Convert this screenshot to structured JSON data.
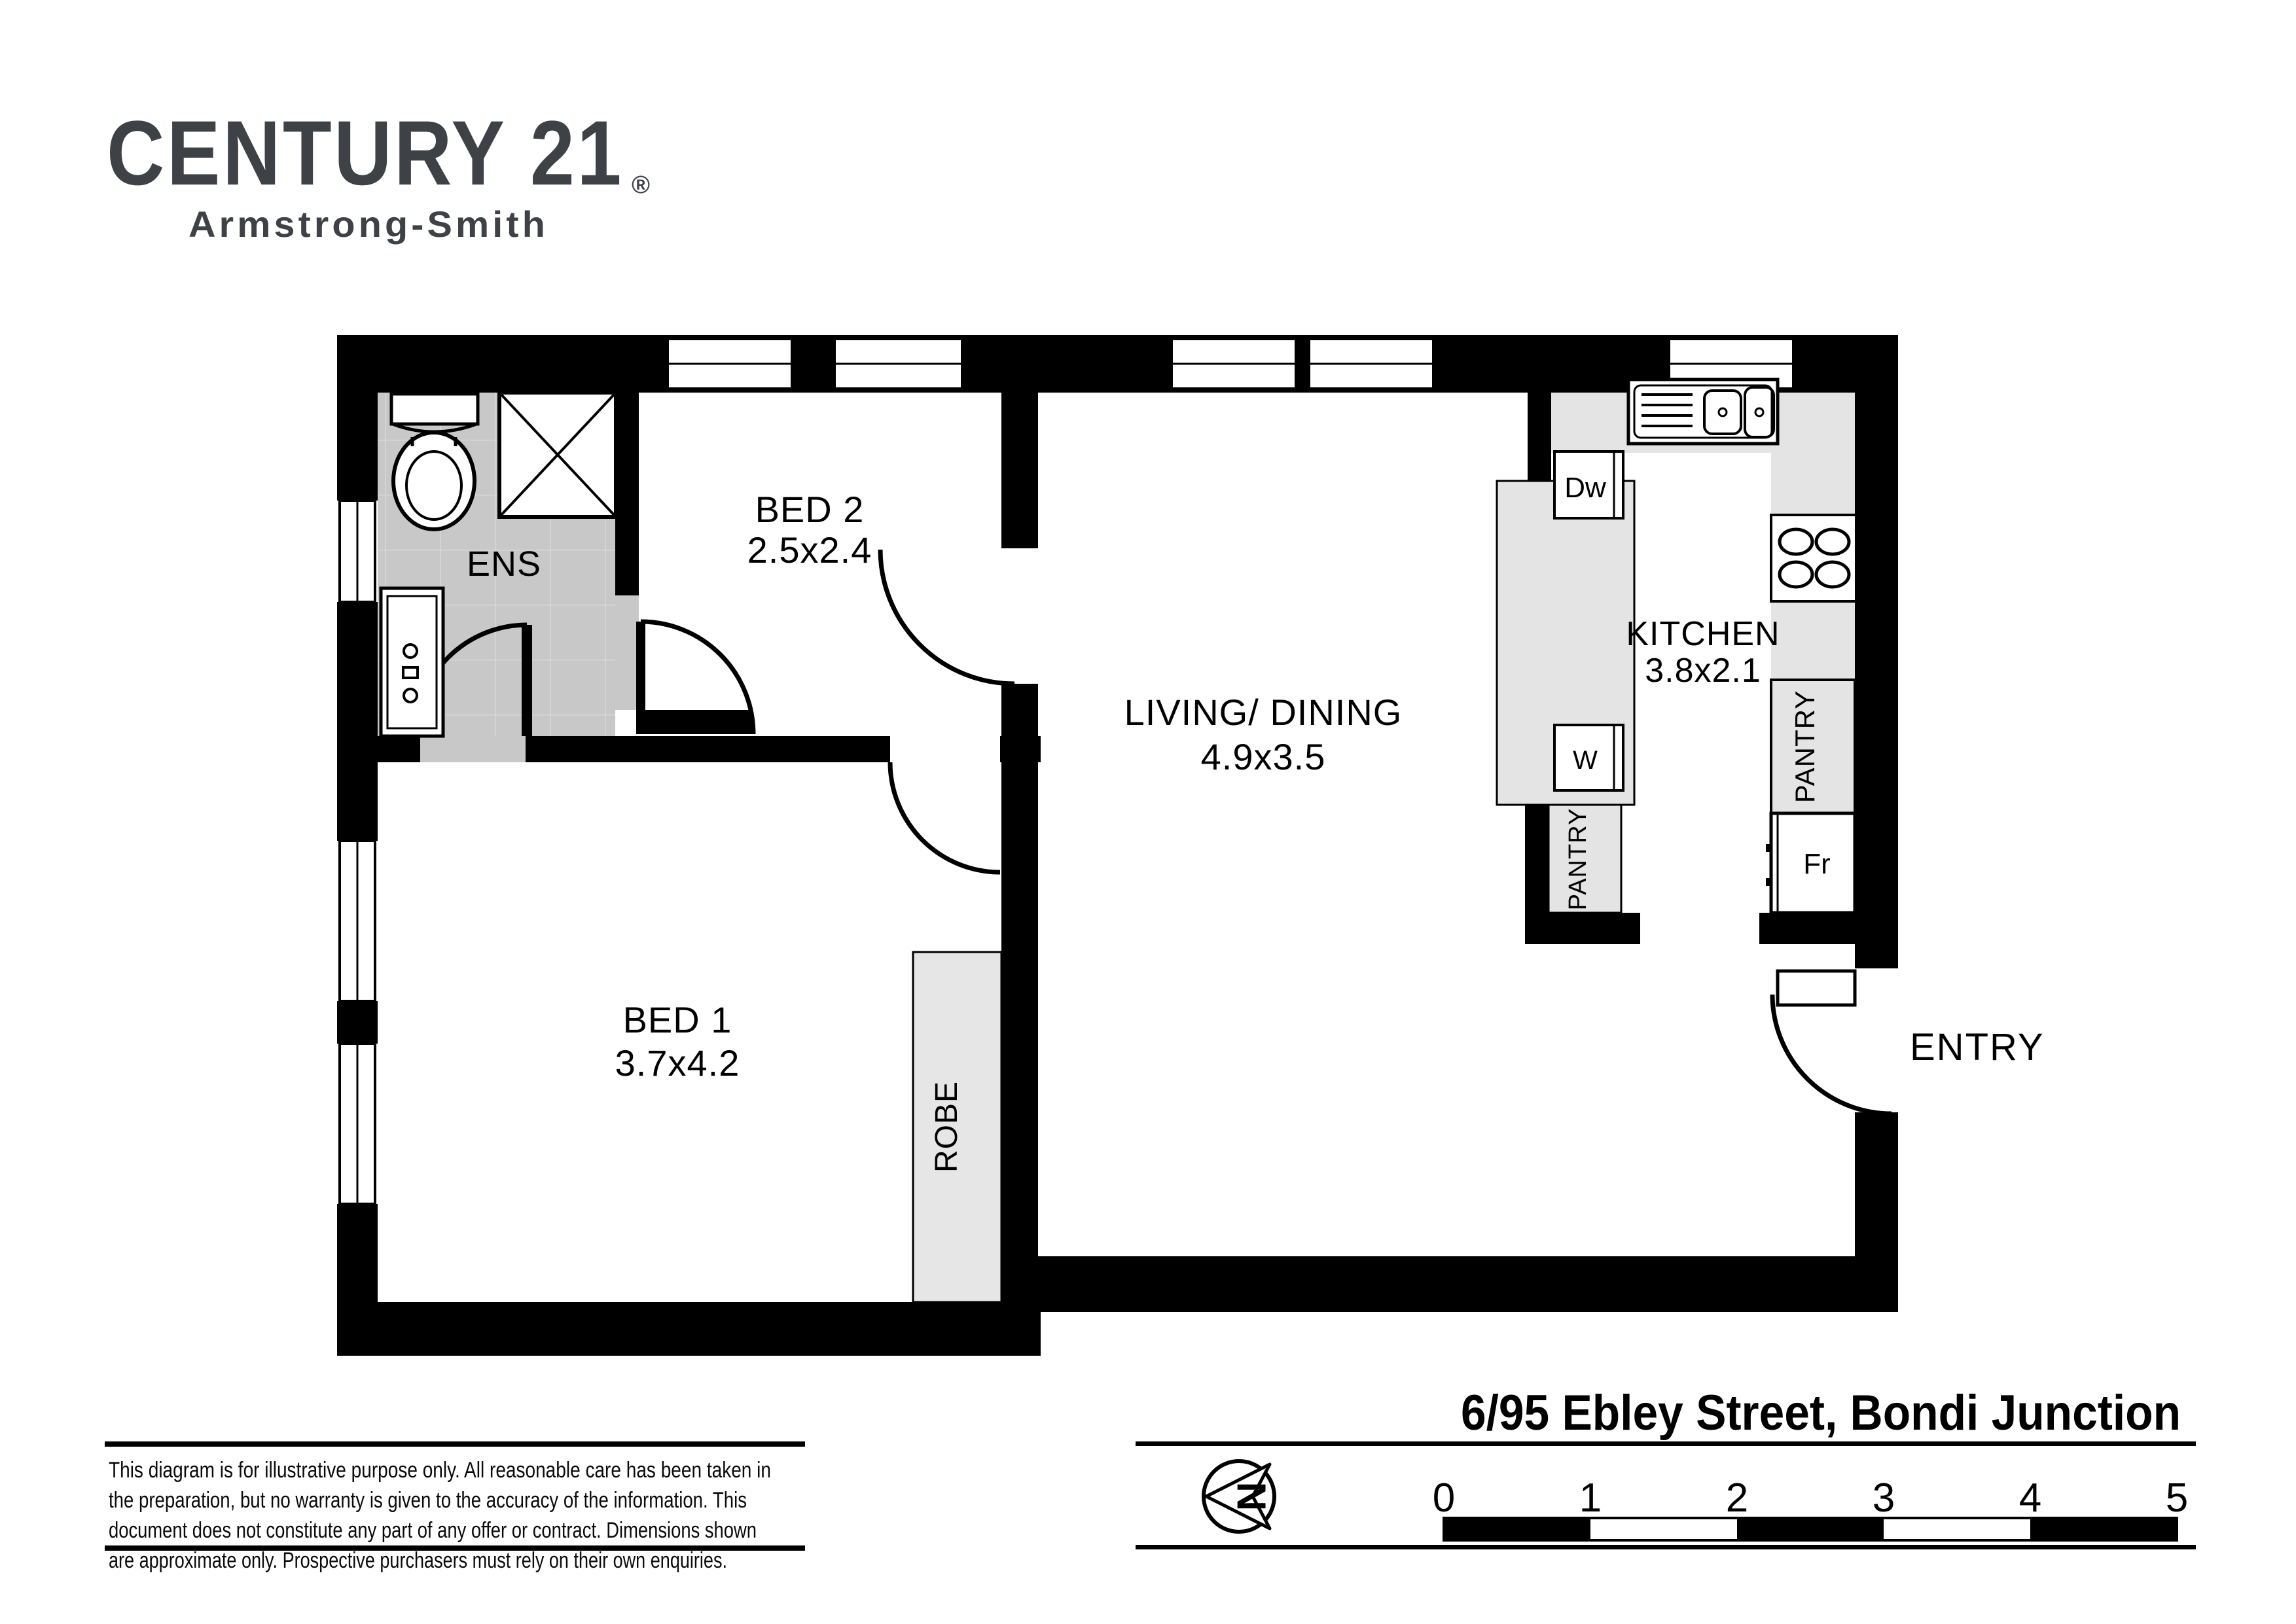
{
  "logo": {
    "brand": "CENTURY 21",
    "registered": "®",
    "sub_brand": "Armstrong-Smith"
  },
  "address": "6/95 Ebley Street, Bondi Junction",
  "rooms": {
    "ens": {
      "name": "ENS",
      "dims": ""
    },
    "bed2": {
      "name": "BED 2",
      "dims": "2.5x2.4"
    },
    "living": {
      "name": "LIVING/ DINING",
      "dims": "4.9x3.5"
    },
    "kitchen": {
      "name": "KITCHEN",
      "dims": "3.8x2.1"
    },
    "bed1": {
      "name": "BED 1",
      "dims": "3.7x4.2"
    }
  },
  "features": {
    "robe": "ROBE",
    "pantry_island": "PANTRY",
    "pantry_wall": "PANTRY",
    "dishwasher": "Dw",
    "washer": "W",
    "fridge": "Fr",
    "entry": "ENTRY"
  },
  "north": {
    "label": "N"
  },
  "scale_bar": {
    "ticks": [
      "0",
      "1",
      "2",
      "3",
      "4",
      "5"
    ]
  },
  "disclaimer": {
    "lines": [
      "This diagram is for illustrative purpose only. All reasonable care has been taken in",
      "the preparation, but no warranty is given to the accuracy of the information. This",
      "document does not constitute any part of any offer or contract. Dimensions shown",
      "are approximate only. Prospective purchasers must rely on their own enquiries."
    ]
  },
  "icons": {
    "north_arrow": "north-arrow-icon",
    "toilet": "toilet-icon",
    "shower": "shower-icon",
    "vanity": "vanity-icon",
    "sink": "double-sink-icon",
    "cooktop": "cooktop-icon"
  },
  "colors": {
    "wall": "#000000",
    "ens_floor": "#c8c8c8",
    "kitchen_floor": "#e4e4e4",
    "robe_floor": "#e6e6e6",
    "logo": "#3e4247",
    "background": "#ffffff"
  }
}
